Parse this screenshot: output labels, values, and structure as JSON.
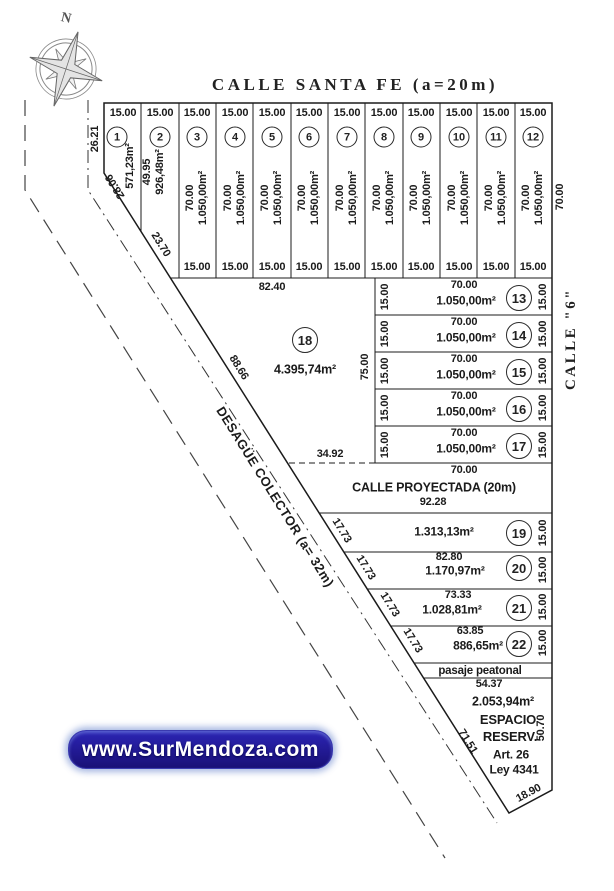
{
  "ink": "#1b1b1b",
  "compass": {
    "label": "N"
  },
  "streets": {
    "top": "CALLE SANTA FE (a=20m)",
    "right": "CALLE \"6\"",
    "projected": "CALLE PROYECTADA (20m)",
    "drain": "DESAGÜE COLECTOR (a= 32m)",
    "passage": "pasaje peatonal"
  },
  "dims": {
    "block_top_width": "82.40",
    "mid_width": "34.92",
    "east_block_height": "75.00",
    "right_side_depth": "70.00",
    "projected_top": "70.00",
    "projected_bottom": "92.28",
    "passage_width": "54.37"
  },
  "top_lots": [
    {
      "num": "1",
      "front": "15.00",
      "area": "571,23m²",
      "side": "26.21",
      "chamfer": "28.06"
    },
    {
      "num": "2",
      "front": "15.00",
      "side": "49.95",
      "area": "926,48m²",
      "chamfer": "23.70"
    },
    {
      "num": "3",
      "front": "15.00",
      "depth": "70.00",
      "area": "1.050,00m²",
      "back": "15.00"
    },
    {
      "num": "4",
      "front": "15.00",
      "depth": "70.00",
      "area": "1.050,00m²",
      "back": "15.00"
    },
    {
      "num": "5",
      "front": "15.00",
      "depth": "70.00",
      "area": "1.050,00m²",
      "back": "15.00"
    },
    {
      "num": "6",
      "front": "15.00",
      "depth": "70.00",
      "area": "1.050,00m²",
      "back": "15.00"
    },
    {
      "num": "7",
      "front": "15.00",
      "depth": "70.00",
      "area": "1.050,00m²",
      "back": "15.00"
    },
    {
      "num": "8",
      "front": "15.00",
      "depth": "70.00",
      "area": "1.050,00m²",
      "back": "15.00"
    },
    {
      "num": "9",
      "front": "15.00",
      "depth": "70.00",
      "area": "1.050,00m²",
      "back": "15.00"
    },
    {
      "num": "10",
      "front": "15.00",
      "depth": "70.00",
      "area": "1.050,00m²",
      "back": "15.00"
    },
    {
      "num": "11",
      "front": "15.00",
      "depth": "70.00",
      "area": "1.050,00m²",
      "back": "15.00"
    },
    {
      "num": "12",
      "front": "15.00",
      "depth": "70.00",
      "area": "1.050,00m²",
      "back": "15.00"
    }
  ],
  "lot18": {
    "num": "18",
    "area": "4.395,74m²",
    "diag": "88.66"
  },
  "east_lots": [
    {
      "num": "13",
      "depth": "70.00",
      "area": "1.050,00m²",
      "left": "15.00",
      "right": "15.00"
    },
    {
      "num": "14",
      "depth": "70.00",
      "area": "1.050,00m²",
      "left": "15.00",
      "right": "15.00"
    },
    {
      "num": "15",
      "depth": "70.00",
      "area": "1.050,00m²",
      "left": "15.00",
      "right": "15.00"
    },
    {
      "num": "16",
      "depth": "70.00",
      "area": "1.050,00m²",
      "left": "15.00",
      "right": "15.00"
    },
    {
      "num": "17",
      "depth": "70.00",
      "area": "1.050,00m²",
      "left": "15.00",
      "right": "15.00"
    }
  ],
  "south_lots": [
    {
      "num": "19",
      "area": "1.313,13m²",
      "right": "15.00",
      "diag": "17.73"
    },
    {
      "num": "20",
      "front": "82.80",
      "area": "1.170,97m²",
      "right": "15.00",
      "diag": "17.73"
    },
    {
      "num": "21",
      "front": "73.33",
      "area": "1.028,81m²",
      "right": "15.00",
      "diag": "17.73"
    },
    {
      "num": "22",
      "front": "63.85",
      "area": "886,65m²",
      "right": "15.00",
      "diag": "17.73"
    }
  ],
  "reserve": {
    "area": "2.053,94m²",
    "name1": "ESPACIO",
    "name2": "RESERV.",
    "side_right": "50.70",
    "law1": "Art. 26",
    "law2": "Ley 4341",
    "bottom": "18.90",
    "diag": "71.51"
  },
  "watermark": {
    "text": "www.SurMendoza.com",
    "bg": "#1e17a0",
    "fg": "#ffffff"
  }
}
